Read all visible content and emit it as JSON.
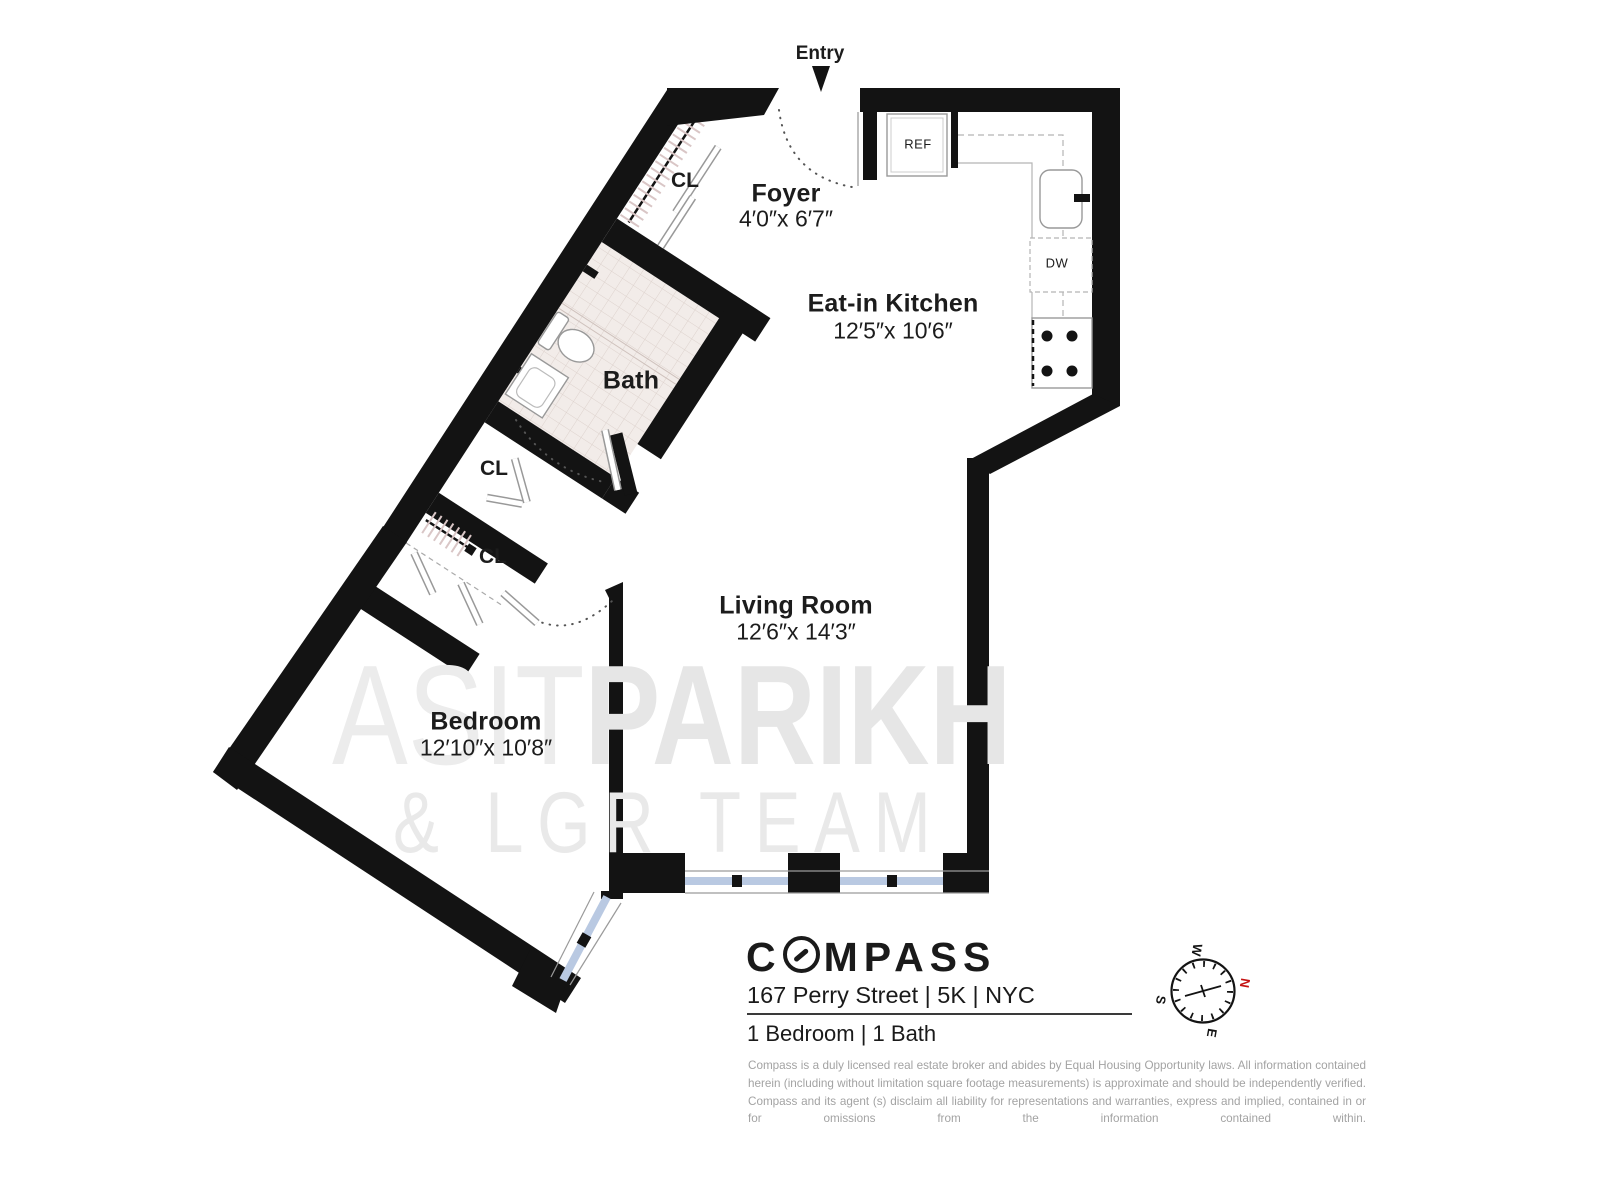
{
  "plan": {
    "entry": {
      "label": "Entry"
    },
    "rooms": [
      {
        "id": "foyer",
        "name": "Foyer",
        "dims": "4′0″x 6′7″"
      },
      {
        "id": "kitchen",
        "name": "Eat-in Kitchen",
        "dims": "12′5″x 10′6″"
      },
      {
        "id": "bath",
        "name": "Bath",
        "dims": ""
      },
      {
        "id": "living",
        "name": "Living Room",
        "dims": "12′6″x 14′3″"
      },
      {
        "id": "bedroom",
        "name": "Bedroom",
        "dims": "12′10″x 10′8″"
      }
    ],
    "closets": [
      {
        "label": "CL"
      },
      {
        "label": "CL"
      },
      {
        "label": "CL"
      }
    ],
    "appliances": {
      "refrigerator": "REF",
      "dishwasher": "DW"
    }
  },
  "watermark": {
    "name_light": "ASIT",
    "name_bold": "PARIKH",
    "team": "& LGR TEAM"
  },
  "footer": {
    "brand": "COMPASS",
    "brand_before": "C",
    "brand_after": "MPASS",
    "address": "167 Perry Street | 5K | NYC",
    "summary": "1 Bedroom | 1 Bath",
    "disclaimer": "Compass is a duly licensed real estate broker and abides by Equal Housing Opportunity laws. All information contained herein (including without limitation square footage measurements) is approximate and should be independently verified. Compass and its agent (s) disclaim all liability for representations and warranties, express and implied, contained in or for omissions from the information contained within."
  },
  "compass_rose": {
    "north": "N",
    "south": "S",
    "east": "E",
    "west": "W"
  },
  "colors": {
    "wall": "#131313",
    "window_glass": "#b9c9e2",
    "tile_bg": "#f2ece9",
    "tile_line": "#ddd2cd",
    "watermark": "#e9e9e9",
    "north_red": "#c41212",
    "disclaimer_gray": "#a3a3a3"
  }
}
